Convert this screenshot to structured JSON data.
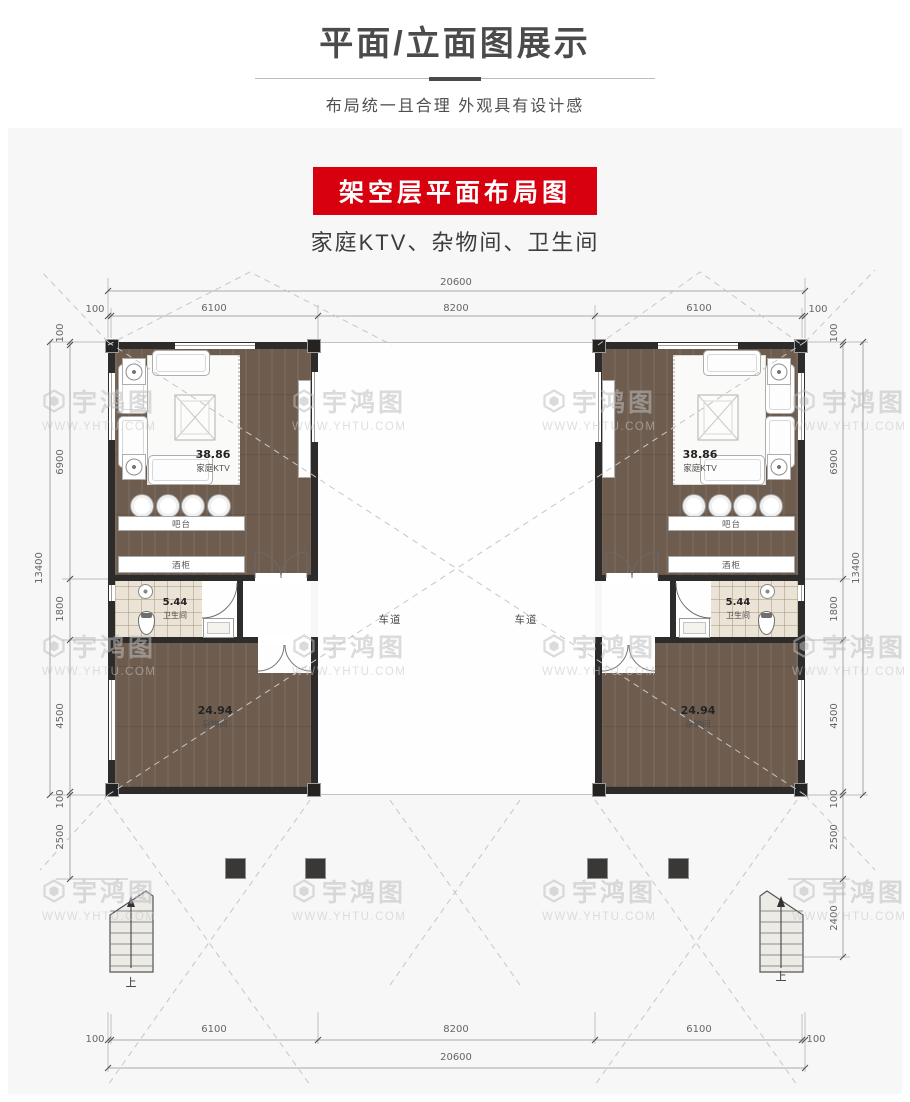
{
  "header": {
    "title": "平面/立面图展示",
    "subtitle": "布局统一且合理 外观具有设计感"
  },
  "section": {
    "banner": "架空层平面布局图",
    "caption": "家庭KTV、杂物间、卫生间"
  },
  "watermark": {
    "brand": "宇鸿图",
    "url": "WWW.YHTU.COM"
  },
  "plan": {
    "rooms": {
      "ktv": {
        "area": "38.86",
        "name": "家庭KTV"
      },
      "bath": {
        "area": "5.44",
        "name": "卫生间"
      },
      "storage": {
        "area": "24.94",
        "name": "杂物间"
      },
      "bar_counter": "吧台",
      "wine_cabinet": "酒柜",
      "driveway": "车道",
      "stair_up": "上"
    },
    "dims": {
      "total_w": "20600",
      "w_segments": [
        "100",
        "6100",
        "8200",
        "6100",
        "100"
      ],
      "total_h": "13400",
      "h_segments": [
        "100",
        "6900",
        "1800",
        "4500",
        "100"
      ],
      "porch_depth": "2500",
      "stair_depth": "2400"
    },
    "colors": {
      "banner_red": "#d8000f",
      "wall": "#2e2c2b",
      "wood_floor": "#6e5d4f",
      "tile": "#ebe4d6"
    }
  }
}
